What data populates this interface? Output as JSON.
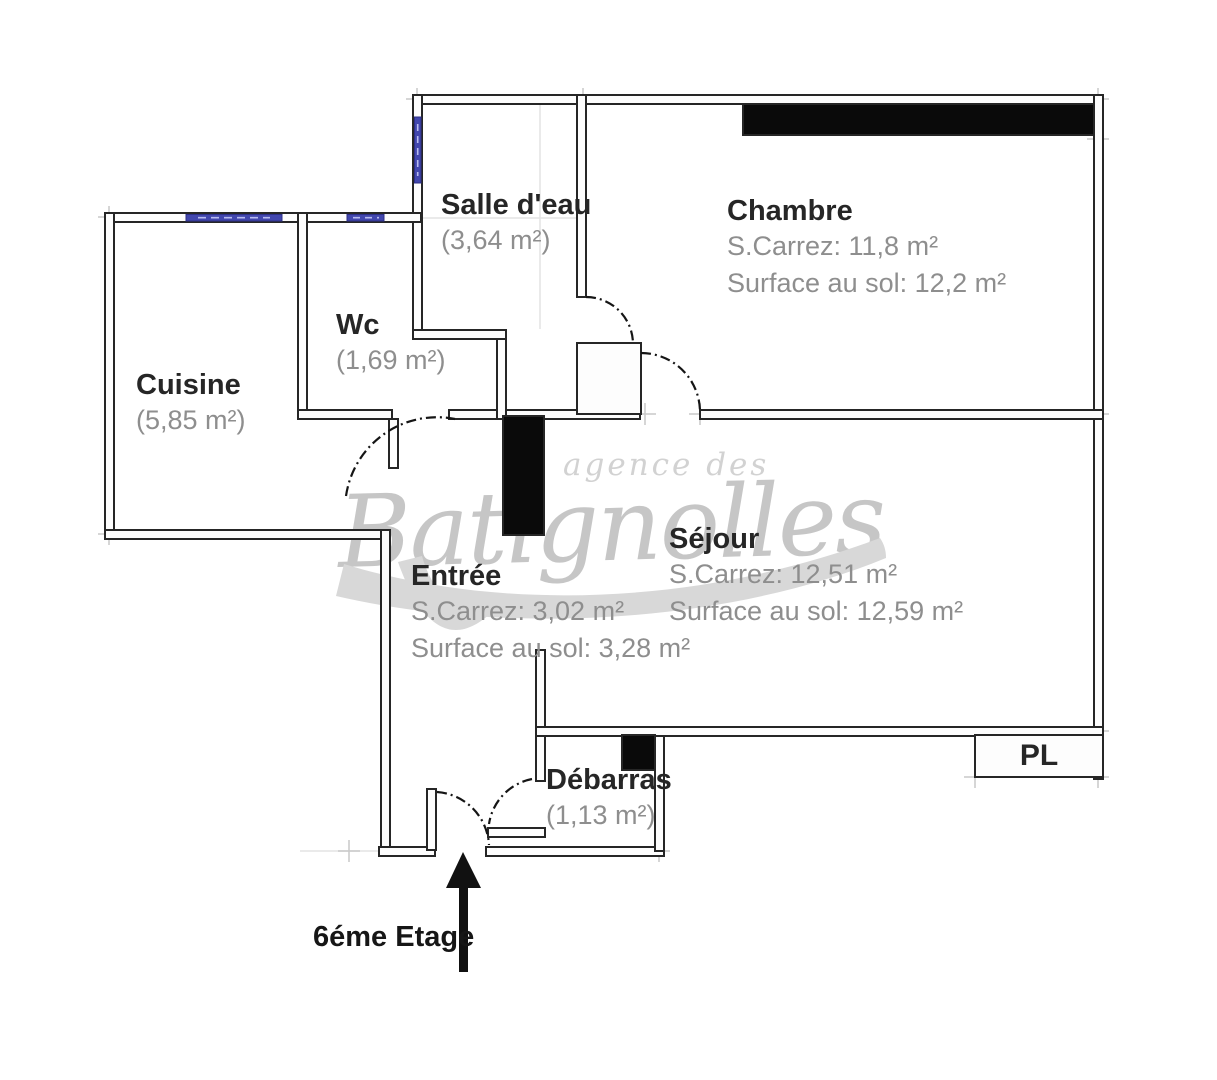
{
  "plan": {
    "floor_label": "6éme Etage",
    "closet_label": "PL",
    "watermark": {
      "line1": "agence des",
      "line2": "Batignolles"
    },
    "rooms": {
      "salle_deau": {
        "name": "Salle d'eau",
        "area": "(3,64 m²)"
      },
      "chambre": {
        "name": "Chambre",
        "carrez": "S.Carrez: 11,8 m²",
        "surface": "Surface au sol: 12,2 m²"
      },
      "cuisine": {
        "name": "Cuisine",
        "area": "(5,85 m²)"
      },
      "wc": {
        "name": "Wc",
        "area": "(1,69 m²)"
      },
      "entree": {
        "name": "Entrée",
        "carrez": "S.Carrez: 3,02 m²",
        "surface": "Surface au sol: 3,28 m²"
      },
      "sejour": {
        "name": "Séjour",
        "carrez": "S.Carrez: 12,51 m²",
        "surface": "Surface au sol: 12,59 m²"
      },
      "debarras": {
        "name": "Débarras",
        "area": "(1,13 m²)"
      }
    },
    "colors": {
      "wall_line": "#262626",
      "wall_fill": "#fdfdfd",
      "black_fill": "#0a0a0a",
      "window_blue": "#4247ae",
      "title_text": "#262626",
      "sub_text": "#8e8e8e",
      "watermark_gray": "#c6c6c6"
    }
  }
}
